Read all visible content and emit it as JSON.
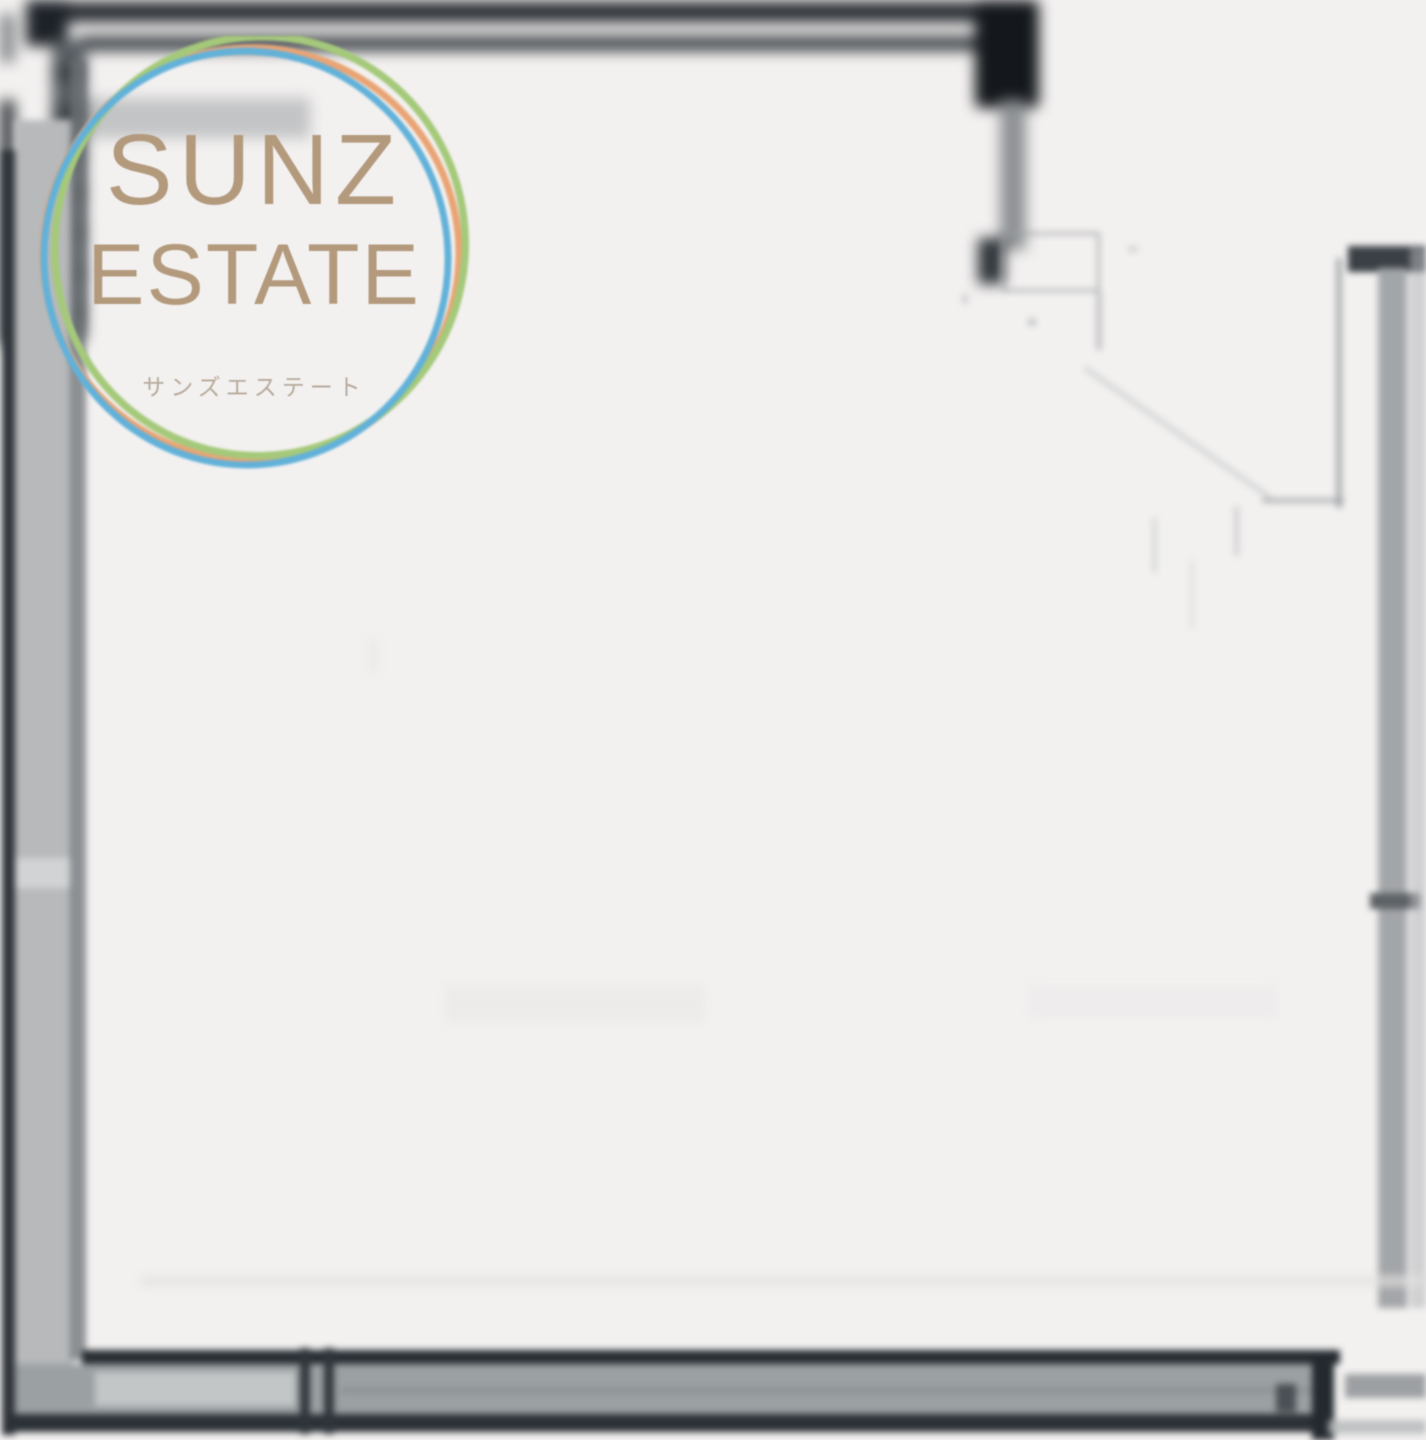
{
  "brand": {
    "name_line1": "SUNZ",
    "name_line2": "ESTATE",
    "subtitle_jp": "サンズエステート",
    "text_color": "#b49a7d",
    "subtitle_color": "#b7aa9c",
    "rings": [
      {
        "name": "orange-ring",
        "color": "#e9a475"
      },
      {
        "name": "green-ring",
        "color": "#a5c97a"
      },
      {
        "name": "blue-ring",
        "color": "#62b1d9"
      }
    ]
  },
  "floor_plan": {
    "wall_color_dark": "#262c32",
    "wall_color_gray": "#9ba0a3",
    "background_color": "#f3f1f0"
  }
}
